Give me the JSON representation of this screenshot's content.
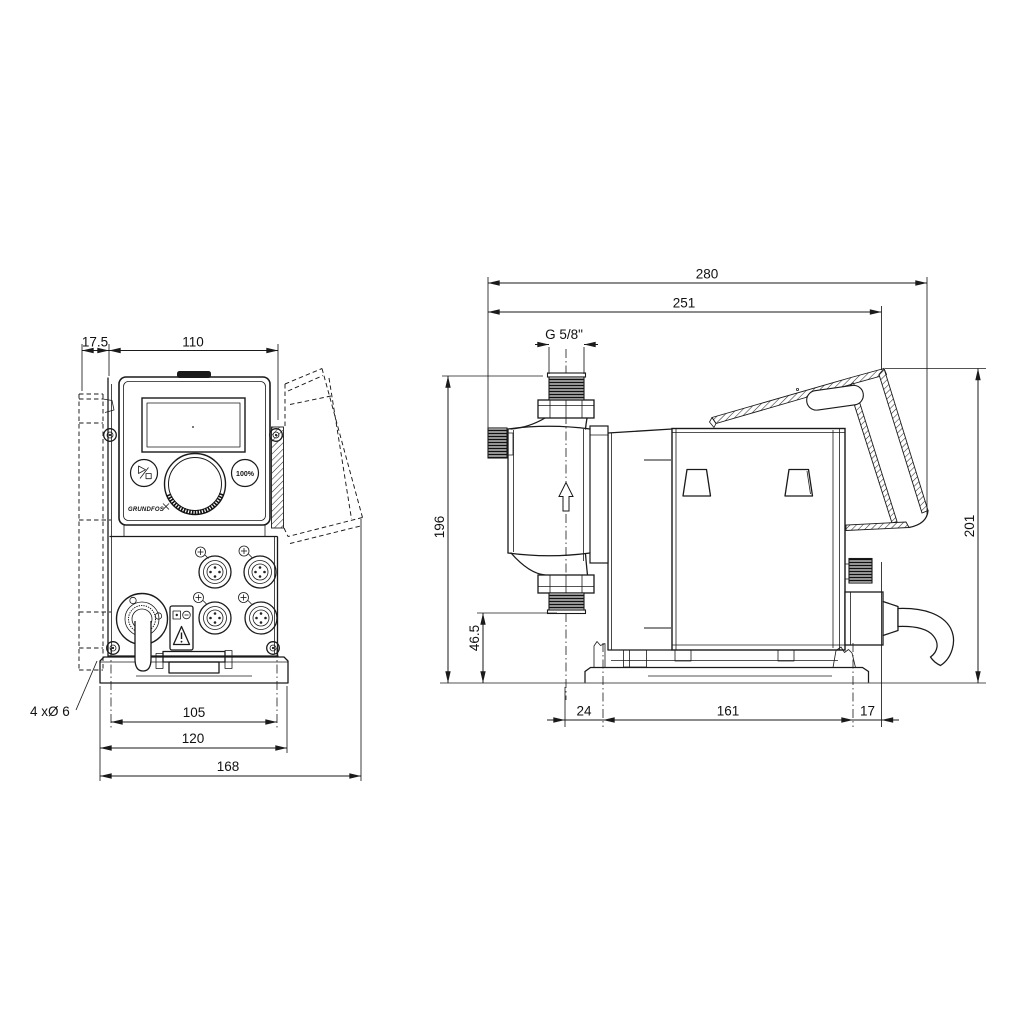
{
  "drawing_title": "Dosing pump dimensional drawing, front and side views",
  "front": {
    "dim_offset": "17.5",
    "dim_width": "110",
    "dim_holes": "105",
    "dim_base": "120",
    "dim_overall": "168",
    "note_holes": "4 xØ 6",
    "logo": "GRUNDFOS",
    "btn_100": "100%"
  },
  "side": {
    "dim_overall": "280",
    "dim_body": "251",
    "thread": "G 5/8\"",
    "dim_height": "196",
    "dim_port": "46.5",
    "dim_rear_height": "201",
    "dim_head_offset": "24",
    "dim_holes": "161",
    "dim_rear": "17"
  },
  "icons": {
    "start_stop_button": "play-stop-glyph",
    "max_capacity_button": "100 percent",
    "click_wheel": "rotary-dial",
    "warning_label": "exclamation-triangle",
    "flow_direction": "arrow-up",
    "mounting_note_leader": "leader-line"
  }
}
